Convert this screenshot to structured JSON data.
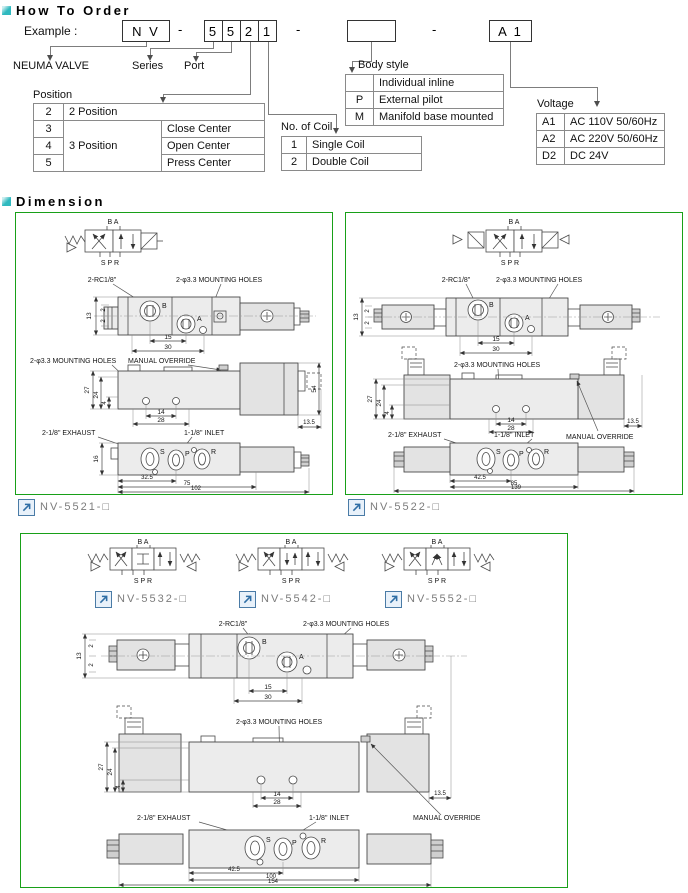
{
  "order": {
    "title": "How To Order",
    "example_label": "Example :",
    "code": {
      "prefix": "N V",
      "digits": [
        "5",
        "5",
        "2",
        "1"
      ],
      "blank": "",
      "suffix": "A 1",
      "dash": "-"
    },
    "callouts": {
      "neuma": "NEUMA VALVE",
      "series": "Series",
      "port": "Port"
    },
    "position": {
      "title": "Position",
      "row2_code": "2",
      "row2_label": "2 Position",
      "group": "3 Position",
      "rows": [
        {
          "code": "3",
          "label": "Close Center"
        },
        {
          "code": "4",
          "label": "Open Center"
        },
        {
          "code": "5",
          "label": "Press Center"
        }
      ]
    },
    "coil": {
      "title": "No. of Coil",
      "rows": [
        {
          "code": "1",
          "label": "Single Coil"
        },
        {
          "code": "2",
          "label": "Double Coil"
        }
      ]
    },
    "body_style": {
      "title": "Body style",
      "rows": [
        {
          "code": "",
          "label": "Individual inline"
        },
        {
          "code": "P",
          "label": "External pilot"
        },
        {
          "code": "M",
          "label": "Manifold base mounted"
        }
      ]
    },
    "voltage": {
      "title": "Voltage",
      "rows": [
        {
          "code": "A1",
          "label": "AC 110V 50/60Hz"
        },
        {
          "code": "A2",
          "label": "AC 220V 50/60Hz"
        },
        {
          "code": "D2",
          "label": "DC 24V"
        }
      ]
    }
  },
  "dimension": {
    "title": "Dimension",
    "sym_top": "B A",
    "sym_bottom": "S P R",
    "ports": {
      "b": "B",
      "a": "A",
      "s": "S",
      "p": "P",
      "r": "R"
    },
    "panel1": {
      "caption": "NV-5521-□",
      "labels": {
        "rc": "2-RC1/8\"",
        "mounting1": "2-φ3.3 MOUNTING HOLES",
        "mounting2": "2-φ3.3 MOUNTING HOLES",
        "manual": "MANUAL OVERRIDE",
        "exhaust": "2-1/8\" EXHAUST",
        "inlet": "1-1/8\" INLET"
      },
      "dims": {
        "d13": "13",
        "d2a": "2",
        "d2b": "2",
        "d15": "15",
        "d30": "30",
        "d27": "27",
        "d24": "24",
        "d4": "4",
        "d14": "14",
        "d28": "28",
        "d54": "54",
        "d135": "13.5",
        "d16": "16",
        "w1": "32.5",
        "w2": "75",
        "w3": "102"
      }
    },
    "panel2": {
      "caption": "NV-5522-□",
      "labels": {
        "rc": "2-RC1/8\"",
        "mounting1": "2-φ3.3 MOUNTING HOLES",
        "mounting2": "2-φ3.3 MOUNTING HOLES",
        "manual": "MANUAL OVERRIDE",
        "exhaust": "2-1/8\" EXHAUST",
        "inlet": "1-1/8\" INLET"
      },
      "dims": {
        "d13": "13",
        "d2a": "2",
        "d2b": "2",
        "d15": "15",
        "d30": "30",
        "d27": "27",
        "d24": "24",
        "d4": "4",
        "d14": "14",
        "d28": "28",
        "d135": "13.5",
        "w1": "42.5",
        "w2": "85",
        "w3": "139"
      }
    },
    "panel3": {
      "captions": [
        "NV-5532-□",
        "NV-5542-□",
        "NV-5552-□"
      ],
      "labels": {
        "rc": "2-RC1/8\"",
        "mounting1": "2-φ3.3 MOUNTING HOLES",
        "mounting2": "2-φ3.3 MOUNTING HOLES",
        "manual": "MANUAL OVERRIDE",
        "exhaust": "2-1/8\" EXHAUST",
        "inlet": "1-1/8\" INLET"
      },
      "dims": {
        "d13": "13",
        "d2a": "2",
        "d2b": "2",
        "d15": "15",
        "d30": "30",
        "d27": "27",
        "d24": "24",
        "d4": "4",
        "d14": "14",
        "d28": "28",
        "d135": "13.5",
        "w1": "42.5",
        "w2": "100",
        "w3": "154"
      }
    }
  }
}
